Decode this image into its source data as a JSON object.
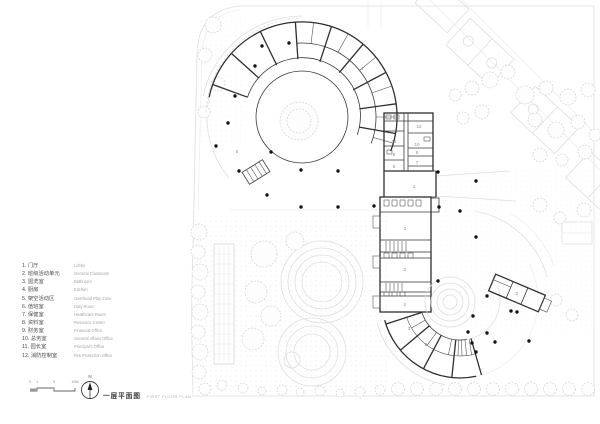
{
  "legend": {
    "items": [
      {
        "label": "1. 门厅",
        "en": "Lobby"
      },
      {
        "label": "2. 班级活动单元",
        "en": "General Classroom"
      },
      {
        "label": "3. 盥洗室",
        "en": "Bathroom"
      },
      {
        "label": "4. 厨房",
        "en": "Kitchen"
      },
      {
        "label": "5. 架空活动区",
        "en": "Overhead Play Zone"
      },
      {
        "label": "6. 值班室",
        "en": "Duty Room"
      },
      {
        "label": "7. 保健室",
        "en": "Healthcare Room"
      },
      {
        "label": "8. 资料室",
        "en": "Resource Center"
      },
      {
        "label": "9. 财务室",
        "en": "Financial Office"
      },
      {
        "label": "10. 总务室",
        "en": "General Affairs Office"
      },
      {
        "label": "11. 园长室",
        "en": "Principal's Office"
      },
      {
        "label": "12. 消防控制室",
        "en": "Fire Protection Office"
      }
    ]
  },
  "titleblock": {
    "north_label": "N",
    "scale_labels": [
      "0",
      "1",
      "5",
      "10M"
    ],
    "title_zh": "一层平面图",
    "title_en": "FIRST FLOOR PLAN"
  },
  "plan": {
    "room_labels": [
      "5",
      "1",
      "2",
      "2",
      "2",
      "3",
      "2",
      "2",
      "11",
      "12",
      "10",
      "8",
      "9",
      "6",
      "7",
      "4"
    ],
    "colors": {
      "wall": "#2e2e2e",
      "site": "#dedede",
      "column": "#141414",
      "background": "#ffffff"
    }
  }
}
